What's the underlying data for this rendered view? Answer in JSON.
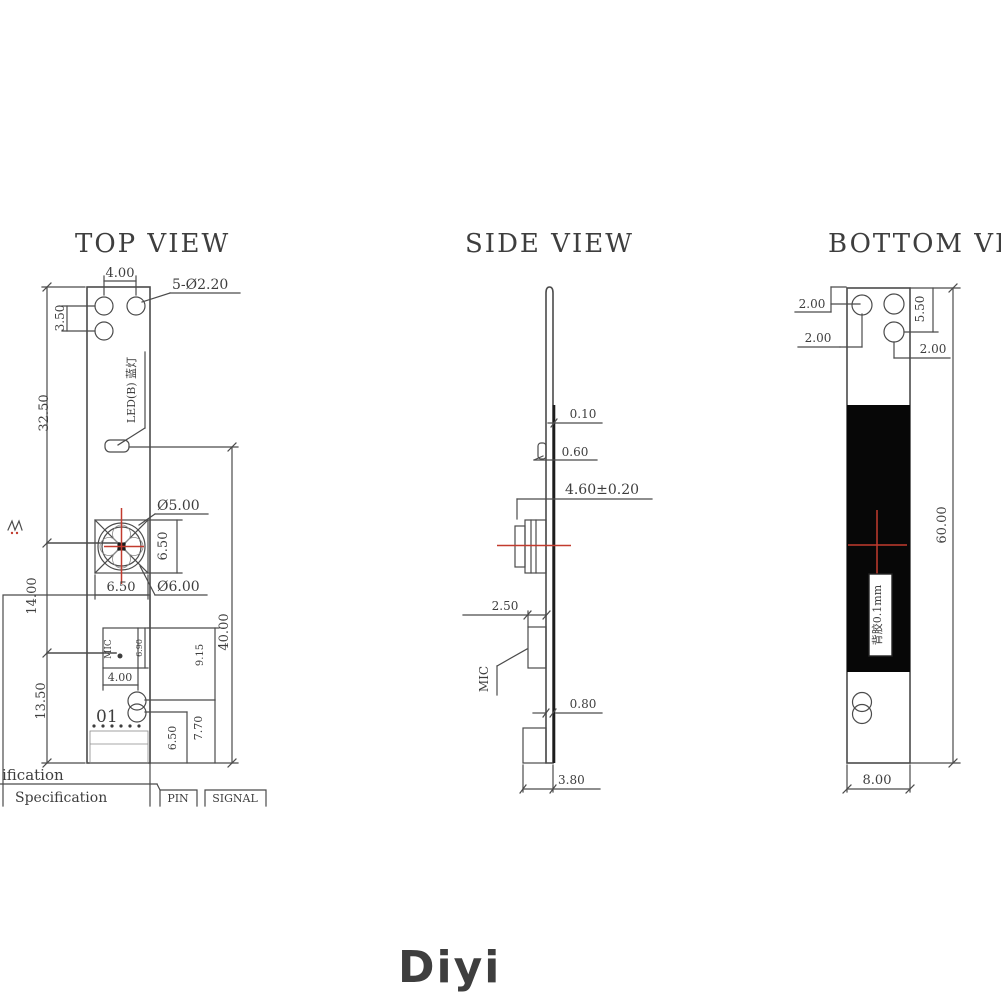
{
  "watermark": {
    "text": "Diyi"
  },
  "colors": {
    "line": "#4b4b4b",
    "red": "#c23b2e",
    "fill_black": "#070707",
    "watermark": "#d6d6d6"
  },
  "top_view": {
    "title": "TOP VIEW",
    "dims": {
      "hole_pitch": "4.00",
      "holes_note": "5-Ø2.20",
      "hole_row_offset": "3.50",
      "top_to_lens": "32.50",
      "lens_to_mic": "14.00",
      "mic_to_bottom": "13.50",
      "lens_inner_dia": "Ø5.00",
      "lens_outer_dia": "Ø6.00",
      "lens_box_w": "6.50",
      "lens_box_h": "6.50",
      "mic_w": "4.00",
      "mic_h": "6.90",
      "mic_to_slot": "9.15",
      "slot_upper_to_bottom": "7.70",
      "slot_lower_to_bottom": "6.50",
      "led_to_bottom": "40.00"
    },
    "labels": {
      "led": "LED(B) 蓝灯",
      "mic": "MIC",
      "pin1": "01"
    },
    "table": {
      "row1": "ification",
      "row2": "Specification",
      "col_pin": "PIN",
      "col_signal": "SIGNAL"
    }
  },
  "side_view": {
    "title": "SIDE VIEW",
    "dims": {
      "tape_t": "0.10",
      "comp_t": "0.60",
      "lens_h": "4.60±0.20",
      "mic_t": "2.50",
      "board_t": "0.80",
      "conn_w": "3.80"
    },
    "labels": {
      "mic": "MIC"
    }
  },
  "bottom_view": {
    "title": "BOTTOM VIEW",
    "dims": {
      "hole_edge_top": "2.00",
      "hole_edge_left": "2.00",
      "hole2_edge": "5.50",
      "hole3_edge": "2.00",
      "length": "60.00",
      "width": "8.00"
    },
    "labels": {
      "adhesive": "背胶0.1mm"
    }
  }
}
